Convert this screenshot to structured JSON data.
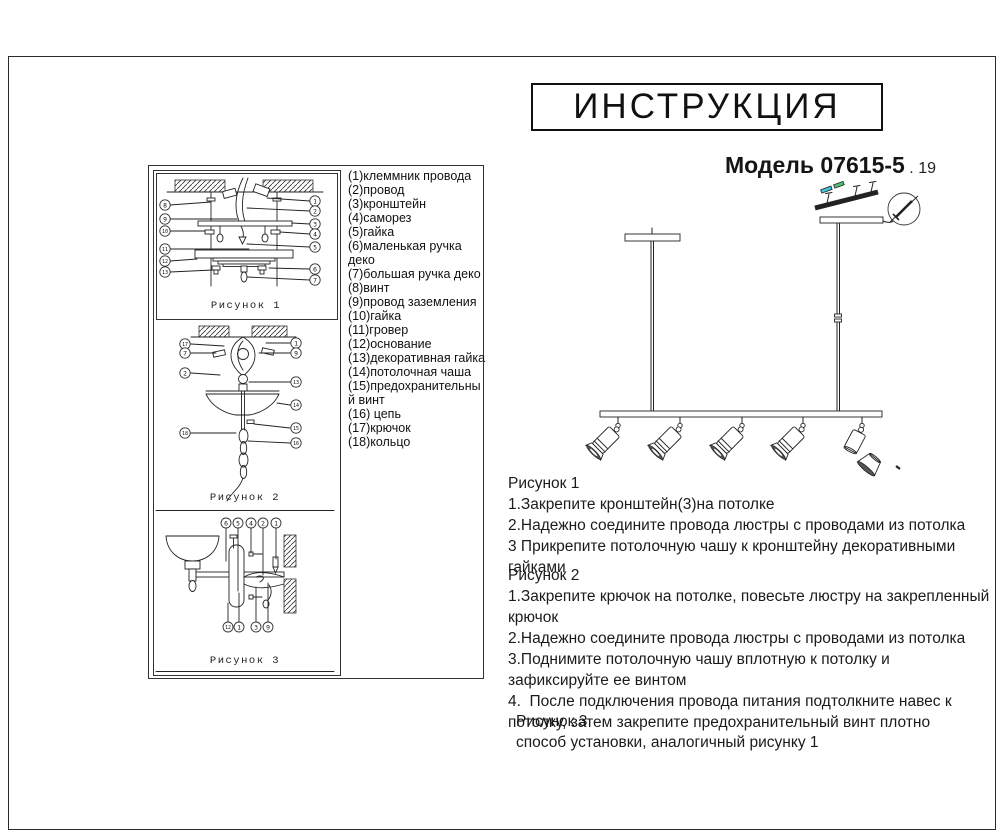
{
  "header": {
    "title": "ИНСТРУКЦИЯ",
    "model_label": "Модель 07615-5",
    "model_suffix": " . 19"
  },
  "colors": {
    "ink": "#222222",
    "screw_highlight_cyan": "#45c6d6",
    "screw_highlight_green": "#52bd78"
  },
  "parts_list": {
    "items": [
      "(1)клеммник провода",
      "(2)провод",
      "(3)кронштейн",
      "(4)саморез",
      "(5)гайка",
      "(6)маленькая ручка деко",
      "(7)большая ручка деко",
      "(8)винт",
      "(9)провод заземления",
      "(10)гайка",
      "(11)гровер",
      "(12)основание",
      "(13)декоративная гайка",
      "(14)потолочная чаша",
      "(15)предохранительный винт",
      "(16) цепь",
      "(17)крючок",
      "(18)кольцо"
    ]
  },
  "figures": {
    "fig1": {
      "label": "Рисунок 1",
      "left_callouts": [
        "8",
        "9",
        "10",
        "11",
        "12",
        "13"
      ],
      "right_callouts": [
        "1",
        "2",
        "3",
        "4",
        "5",
        "6",
        "7"
      ]
    },
    "fig2": {
      "label": "Рисунок 2",
      "left_callouts": [
        "17",
        "7",
        "2",
        "18"
      ],
      "right_callouts": [
        "1",
        "9",
        "13",
        "14",
        "15",
        "16"
      ]
    },
    "fig3": {
      "label": "Рисунок 3",
      "top_callouts": [
        "6",
        "5",
        "4",
        "2",
        "1"
      ],
      "bottom_callouts": [
        "12",
        "1",
        "3",
        "9"
      ]
    }
  },
  "instructions": {
    "fig1": {
      "heading": "Рисунок 1",
      "steps": [
        "1.Закрепите кронштейн(3)на потолке",
        "2.Надежно соедините провода люстры с проводами из потолка",
        "3 Прикрепите потолочную чашу к кронштейну декоративными гайками"
      ]
    },
    "fig2": {
      "heading": "Рисунок 2",
      "steps": [
        "1.Закрепите крючок на потолке, повесьте люстру на закрепленный крючок",
        "2.Надежно соедините провода люстры с проводами из потолка",
        "3.Поднимите потолочную чашу вплотную к потолку и зафиксируйте ее винтом",
        "4.  После подключения провода питания подтолкните навес к потолку, затем закрепите предохранительный винт плотно"
      ]
    },
    "fig3": {
      "heading": "Рисунок 3",
      "steps": [
        "способ установки, аналогичный рисунку 1"
      ]
    }
  }
}
